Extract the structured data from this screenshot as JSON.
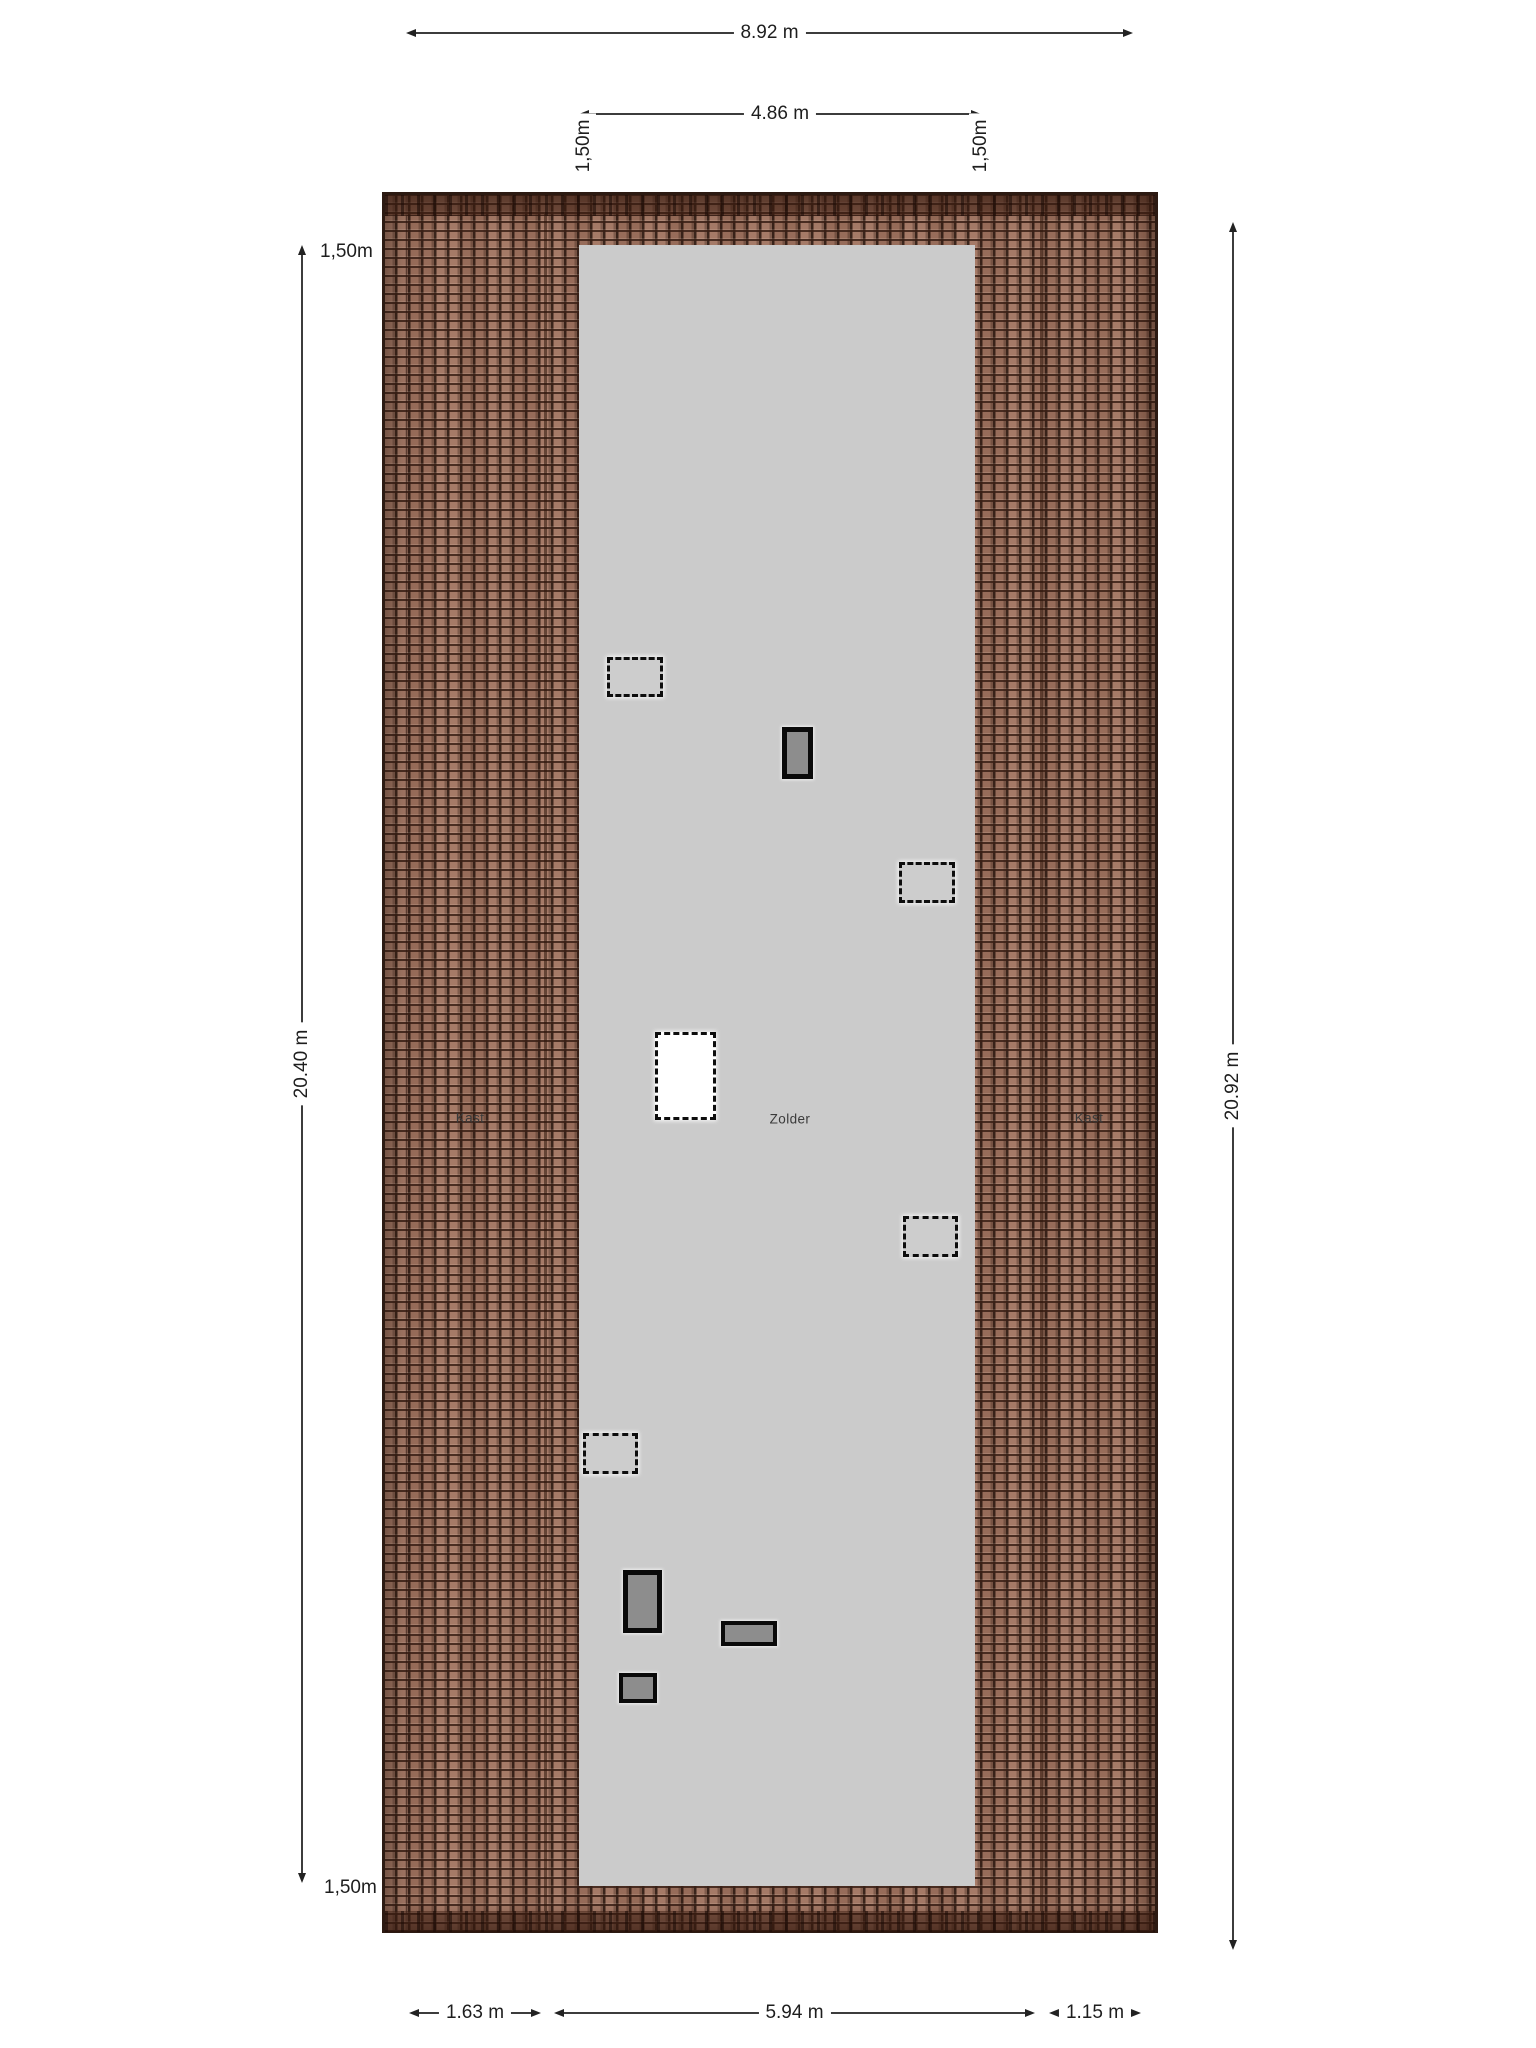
{
  "rooms": [
    {
      "label": "Kast",
      "x": 470,
      "y": 1118
    },
    {
      "label": "Zolder",
      "x": 790,
      "y": 1119
    },
    {
      "label": "Kast",
      "x": 1089,
      "y": 1118
    }
  ],
  "plan": {
    "roof": {
      "x": 382,
      "y": 192,
      "w": 776,
      "h": 1741
    },
    "wall_inset": {
      "x": 406,
      "y": 215,
      "w": 727,
      "h": 1697
    },
    "ridge_top": {
      "x": 385,
      "y": 195,
      "w": 770,
      "h": 20
    },
    "ridge_bottom": {
      "x": 385,
      "y": 1911,
      "w": 770,
      "h": 20
    },
    "contour_left": {
      "x": 544,
      "y": 214,
      "w": 3,
      "h": 1697
    },
    "contour_right": {
      "x": 1040,
      "y": 214,
      "w": 3,
      "h": 1697
    },
    "floor": {
      "x": 579,
      "y": 245,
      "w": 396,
      "h": 1641
    }
  },
  "objects": [
    {
      "type": "roof-window-outline",
      "rect": {
        "x": 607,
        "y": 657,
        "w": 56,
        "h": 40
      }
    },
    {
      "type": "chimney",
      "rect": {
        "x": 782,
        "y": 727,
        "w": 31,
        "h": 52
      }
    },
    {
      "type": "roof-window-outline",
      "rect": {
        "x": 899,
        "y": 862,
        "w": 56,
        "h": 41
      }
    },
    {
      "type": "stair-opening",
      "rect": {
        "x": 655,
        "y": 1032,
        "w": 61,
        "h": 88
      }
    },
    {
      "type": "roof-window-outline",
      "rect": {
        "x": 903,
        "y": 1216,
        "w": 55,
        "h": 41
      }
    },
    {
      "type": "roof-window-outline",
      "rect": {
        "x": 583,
        "y": 1433,
        "w": 55,
        "h": 41
      }
    },
    {
      "type": "chimney",
      "rect": {
        "x": 623,
        "y": 1570,
        "w": 39,
        "h": 63
      }
    },
    {
      "type": "roof-vent",
      "rect": {
        "x": 721,
        "y": 1621,
        "w": 56,
        "h": 25
      }
    },
    {
      "type": "roof-vent",
      "rect": {
        "x": 619,
        "y": 1673,
        "w": 38,
        "h": 30
      }
    }
  ],
  "dimensions": {
    "top_width": {
      "label": "8.92 m",
      "rect": {
        "x": 406,
        "y": 24,
        "w": 727,
        "h": 18
      }
    },
    "inner_width": {
      "label": "4.86 m",
      "rect": {
        "x": 579,
        "y": 105,
        "w": 402,
        "h": 18
      }
    },
    "contour_labels": [
      {
        "text": "1,50m",
        "x": 584,
        "y": 146
      },
      {
        "text": "1,50m",
        "x": 981,
        "y": 146
      }
    ],
    "left": {
      "line": {
        "x": 298,
        "y": 245,
        "w": 8,
        "h": 1638
      },
      "top_label": {
        "text": "1,50m",
        "x": 320,
        "y": 252
      },
      "mid_label": {
        "text": "20.40 m",
        "x": 303,
        "y": 1065
      },
      "bottom_label": {
        "text": "1,50m",
        "x": 324,
        "y": 1888
      }
    },
    "right": {
      "line": {
        "x": 1229,
        "y": 222,
        "w": 8,
        "h": 1728
      },
      "label": {
        "text": "20.92 m",
        "x": 1234,
        "y": 1065
      }
    },
    "bottom_segments": [
      {
        "label": "1.63 m",
        "rect": {
          "x": 409,
          "y": 2004,
          "w": 132,
          "h": 18
        }
      },
      {
        "label": "5.94 m",
        "rect": {
          "x": 554,
          "y": 2004,
          "w": 481,
          "h": 18
        }
      },
      {
        "label": "1.15 m",
        "rect": {
          "x": 1049,
          "y": 2004,
          "w": 92,
          "h": 18
        }
      }
    ]
  },
  "colors": {
    "roof_tile": "#a0735f",
    "roof_grout": "#23120b",
    "floor": "#cbcbcb",
    "dimension_line": "#3c3c3c",
    "object_fill": "#8d8d8d",
    "background": "#ffffff"
  }
}
